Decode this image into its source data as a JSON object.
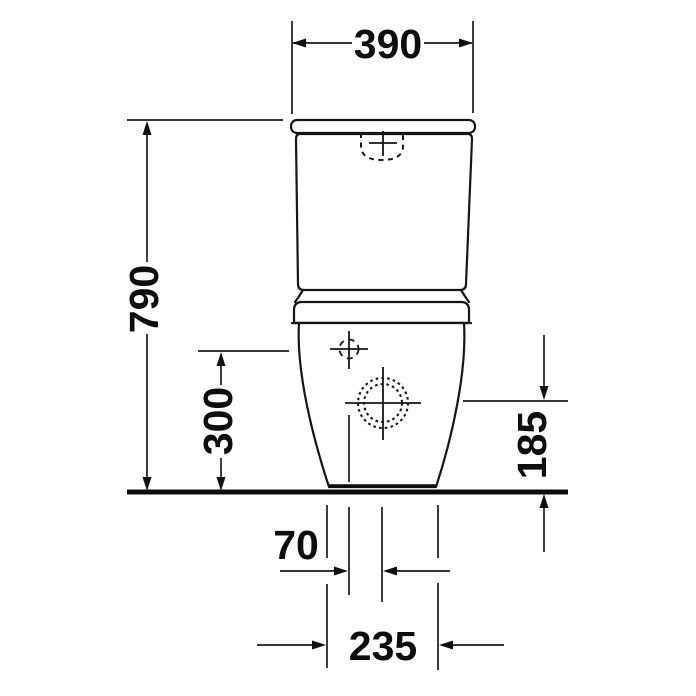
{
  "diagram": {
    "name": "toilet-front-view-technical-drawing",
    "unit": "mm",
    "dimensions": {
      "cistern_width": "390",
      "total_height": "790",
      "supply_height": "300",
      "outlet_height": "185",
      "supply_offset": "70",
      "base_width": "235"
    }
  }
}
